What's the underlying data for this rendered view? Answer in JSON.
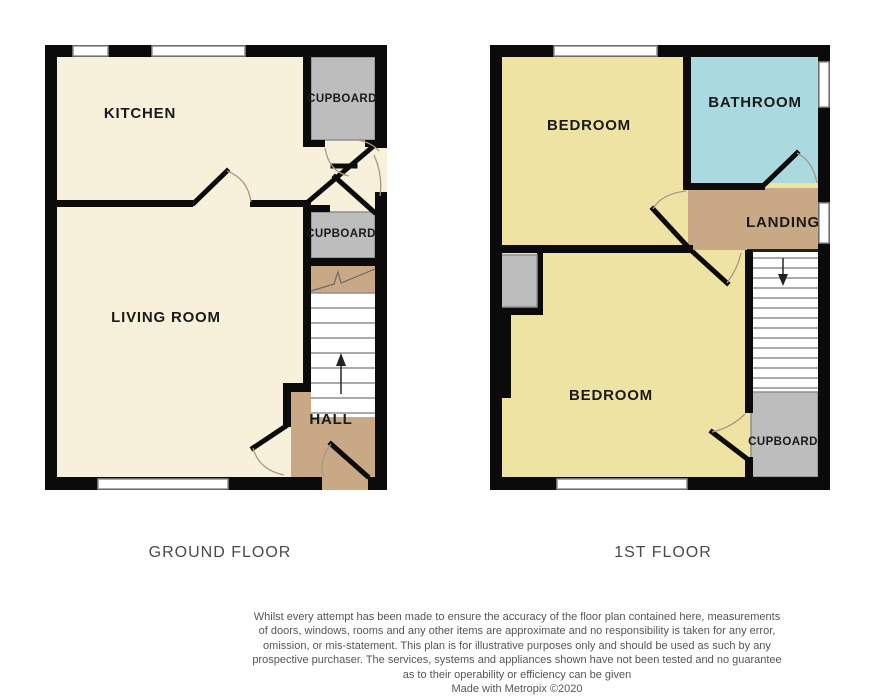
{
  "palette": {
    "wall": "#0b0b0b",
    "ground_floor_room": "#f7f0da",
    "bedroom": "#efe3a4",
    "bathroom": "#aad9df",
    "hall_landing": "#c9a885",
    "cupboard": "#bdbdbd",
    "window_border": "#8f8f8f",
    "door_arc": "#a89a80",
    "caption_text": "#4a4a4a",
    "disclaimer_text": "#555555"
  },
  "ground_floor": {
    "caption": "GROUND FLOOR",
    "rooms": {
      "kitchen": "KITCHEN",
      "living_room": "LIVING ROOM",
      "hall": "HALL",
      "cupboard_top": "CUPBOARD",
      "cupboard_mid": "CUPBOARD"
    }
  },
  "first_floor": {
    "caption": "1ST FLOOR",
    "rooms": {
      "bedroom_front": "BEDROOM",
      "bedroom_back": "BEDROOM",
      "bathroom": "BATHROOM",
      "landing": "LANDING",
      "cupboard": "CUPBOARD"
    }
  },
  "disclaimer": {
    "lines": [
      "Whilst every attempt has been made to ensure the accuracy of the floor plan contained here, measurements",
      "of doors, windows, rooms and any other items are approximate and no responsibility is taken for any error,",
      "omission, or mis-statement. This plan is for illustrative purposes only and should be used as such by any",
      "prospective purchaser. The services, systems and appliances shown have not been tested and no guarantee",
      "as to their operability or efficiency can be given"
    ],
    "credit": "Made with Metropix ©2020"
  }
}
